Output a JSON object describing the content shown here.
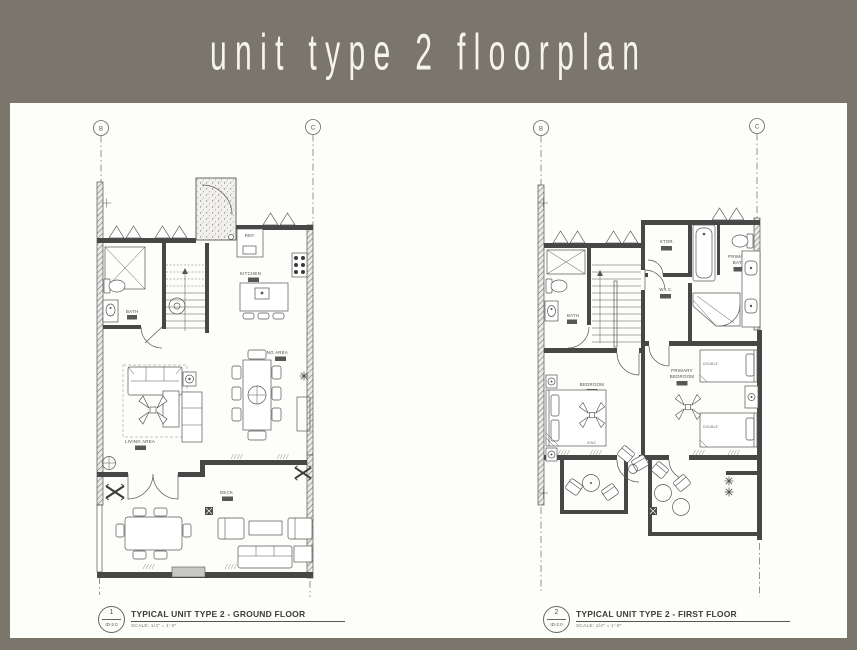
{
  "header": {
    "title": "unit type 2 floorplan"
  },
  "colors": {
    "banner_bg": "#7b766c",
    "paper": "#fdfdfa",
    "line": "#4a4a4a",
    "label": "#4c4c4c"
  },
  "plans": {
    "ground": {
      "grid": {
        "left": "B",
        "right": "C"
      },
      "labels": {
        "ref": "REF.",
        "kitchen": "KITCHEN",
        "bath": "BATH",
        "dining": "DINING AREA",
        "living": "LIVING AREA",
        "deck": "DECK"
      },
      "caption": {
        "number": "1",
        "sheet": "ID-2.0",
        "title": "TYPICAL UNIT TYPE 2 - GROUND FLOOR",
        "scale": "SCALE: 1/4\" = 1'-0\""
      }
    },
    "first": {
      "grid": {
        "left": "B",
        "right": "C"
      },
      "labels": {
        "stor": "STOR.",
        "wic": "W.I.C.",
        "primary_bath_1": "PRIMARY",
        "primary_bath_2": "BATH",
        "bath": "BATH",
        "bedroom": "BEDROOM",
        "king": "KING",
        "primary_bedroom_1": "PRIMARY",
        "primary_bedroom_2": "BEDROOM",
        "double_1": "DOUBLE",
        "double_2": "DOUBLE"
      },
      "caption": {
        "number": "2",
        "sheet": "ID-2.0",
        "title": "TYPICAL UNIT TYPE 2 - FIRST FLOOR",
        "scale": "SCALE: 1/4\" = 1'-0\""
      }
    }
  }
}
